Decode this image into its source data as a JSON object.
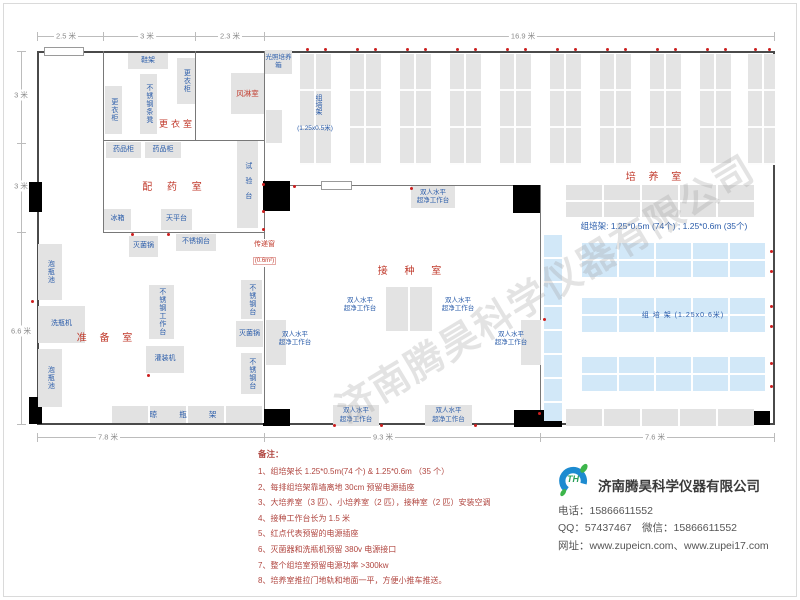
{
  "dimensions": {
    "top": [
      "2.5 米",
      "3 米",
      "2.3 米",
      "16.9 米"
    ],
    "left": [
      "3 米",
      "3 米",
      "6.6 米"
    ],
    "bottom": [
      "7.8 米",
      "9.3 米",
      "7.6 米"
    ]
  },
  "rooms": {
    "dressing": "更衣室",
    "air_shower": "风淋室",
    "dispensing": "配 药 室",
    "prep": "准 备 室",
    "inoculation": "接 种 室",
    "culture": "培 养 室"
  },
  "pass_window": {
    "name": "传递窗",
    "size": "(0.6m²)"
  },
  "equipment": {
    "shoe_rack": "鞋架",
    "locker": "更衣柜",
    "bench": "不锈钢条凳",
    "light_incubator": "光照培养箱",
    "med_cab": "药品柜",
    "test_bench": "试验台",
    "fridge": "冰箱",
    "balance": "天平台",
    "sterilizer": "灭菌锅",
    "ss_table": "不锈钢台",
    "soak_pool": "泡瓶池",
    "washer": "洗瓶机",
    "ss_workbench": "不锈钢工作台",
    "filler": "灌装机",
    "drying_rack": "晾 瓶 架",
    "clean_bench": "双人水平\n超净工作台"
  },
  "racks": {
    "v_label_name": "组培架",
    "v_label_size": "(1.25x0.5米)",
    "blue_label": "组 培 架 (1.25x0.6米)",
    "note": "组培架: 1.25*0.5m (74个) ; 1.25*0.6m (35个)"
  },
  "notes": {
    "title": "备注：",
    "items": [
      "1、组培架长 1.25*0.5m(74 个) & 1.25*0.6m （35 个）",
      "2、每排组培架靠墙离地 30cm 预留电源插座",
      "3、大培养室（3 匹）、小培养室（2 匹），接种室（2 匹）安装空调",
      "4、接种工作台长为 1.5 米",
      "5、红点代表预留的电源插座",
      "6、灭菌器和洗瓶机预留 380v 电源接口",
      "7、整个组培室预留电源功率 >300kw",
      "8、培养室推拉门地轨和地面一平，方便小推车推送。"
    ]
  },
  "company": {
    "logo_text": "TH",
    "name": "济南腾昊科学仪器有限公司",
    "phone": "电话：15866611552",
    "qq_wechat": "QQ：57437467　微信：15866611552",
    "web": "网址：www.zupeicn.com、www.zupei17.com"
  },
  "watermark": "济南腾昊科学仪器有限公司"
}
